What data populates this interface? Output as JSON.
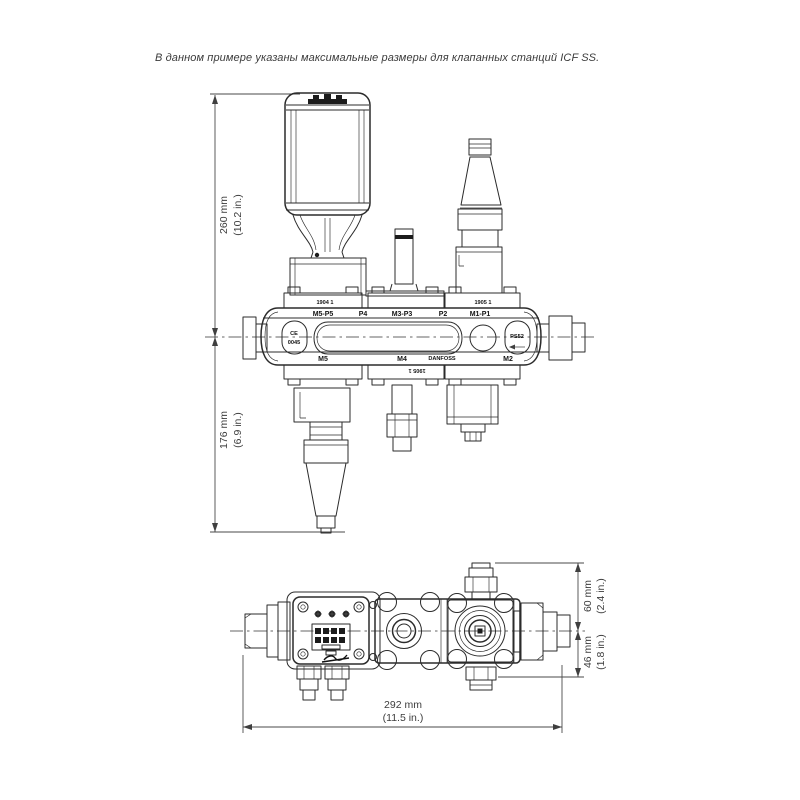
{
  "caption": "В данном примере указаны максимальные размеры для клапанных станций ICF SS.",
  "front_view": {
    "dim_height_top": {
      "mm": "260 mm",
      "in": "(10.2 in.)"
    },
    "dim_height_bottom": {
      "mm": "176 mm",
      "in": "(6.9 in.)"
    },
    "flange_marks": {
      "left": "1904 1",
      "right": "1905 1",
      "bottom": "1905 1"
    },
    "port_labels_top": [
      "M5-P5",
      "P4",
      "M3-P3",
      "P2",
      "M1-P1"
    ],
    "port_labels_bottom": [
      "M5",
      "M4",
      "DANFOSS",
      "M2"
    ],
    "left_cap": {
      "line1": "CE",
      "line2": "0045"
    },
    "right_cap": "PS52"
  },
  "bottom_view": {
    "dim_width": {
      "mm": "292 mm",
      "in": "(11.5 in.)"
    },
    "dim_top": {
      "mm": "60 mm",
      "in": "(2.4 in.)"
    },
    "dim_bottom": {
      "mm": "46 mm",
      "in": "(1.8 in.)"
    }
  }
}
